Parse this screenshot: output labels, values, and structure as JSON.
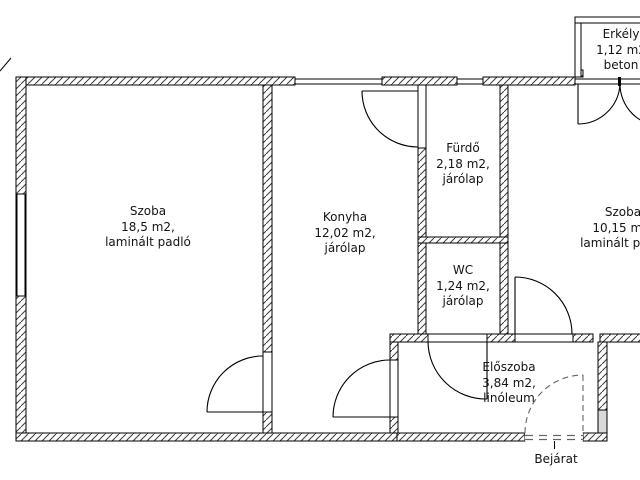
{
  "plan": {
    "rooms": [
      {
        "name": "Szoba",
        "area": "18,5 m2,",
        "floor": "laminált padló"
      },
      {
        "name": "Konyha",
        "area": "12,02 m2,",
        "floor": "járólap"
      },
      {
        "name": "Fürdő",
        "area": "2,18 m2,",
        "floor": "járólap"
      },
      {
        "name": "WC",
        "area": "1,24 m2,",
        "floor": "járólap"
      },
      {
        "name": "Szoba",
        "area": "10,15 m2,",
        "floor": "laminált padló"
      },
      {
        "name": "Előszoba",
        "area": "3,84 m2,",
        "floor": "linóleum"
      },
      {
        "name": "Erkély",
        "area": "1,12 m2",
        "floor": "beton"
      }
    ],
    "entrance_label": "Bejárat",
    "colors": {
      "line": "#000000",
      "hatch": "#3c3c3c",
      "dash": "#666666",
      "graywall": "#d9d9d9"
    }
  }
}
